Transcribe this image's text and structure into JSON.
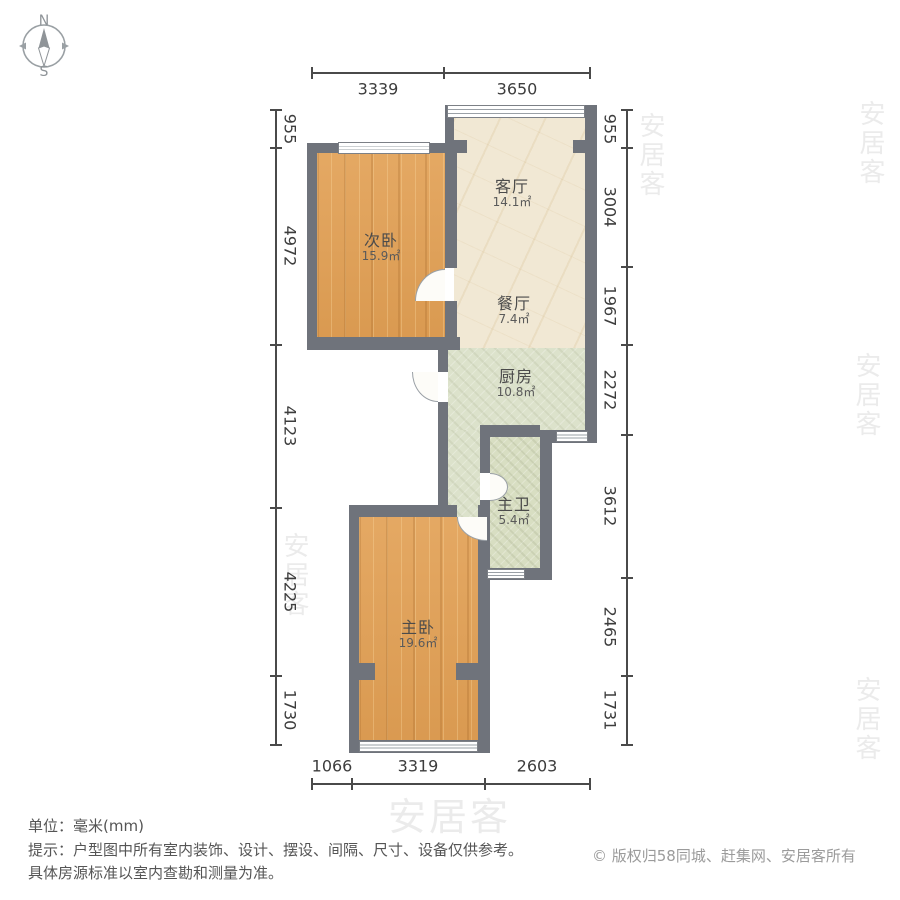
{
  "compass": {
    "north": "N",
    "south": "S"
  },
  "rooms": [
    {
      "key": "secondary_bedroom",
      "name": "次卧",
      "area": "15.9㎡"
    },
    {
      "key": "living_room",
      "name": "客厅",
      "area": "14.1㎡"
    },
    {
      "key": "dining_room",
      "name": "餐厅",
      "area": "7.4㎡"
    },
    {
      "key": "kitchen",
      "name": "厨房",
      "area": "10.8㎡"
    },
    {
      "key": "master_bathroom",
      "name": "主卫",
      "area": "5.4㎡"
    },
    {
      "key": "master_bedroom",
      "name": "主卧",
      "area": "19.6㎡"
    }
  ],
  "dimensions": {
    "top": [
      "3339",
      "3650"
    ],
    "bottom": [
      "1066",
      "3319",
      "2603"
    ],
    "left": [
      "955",
      "4972",
      "4123",
      "4225",
      "1730"
    ],
    "right": [
      "955",
      "3004",
      "1967",
      "2272",
      "3612",
      "2465",
      "1731"
    ]
  },
  "footer": {
    "unit_line": "单位：毫米(mm)",
    "tip_line1": "提示：户型图中所有室内装饰、设计、摆设、间隔、尺寸、设备仅供参考。",
    "tip_line2": "具体房源标准以室内查勘和测量为准。",
    "copyright": "© 版权归58同城、赶集网、安居客所有"
  },
  "watermark": {
    "text": "安居客"
  },
  "colors": {
    "wall": "#6f737b",
    "wood_floor": "#e2a156",
    "marble_floor": "#f1e8d4",
    "tile_floor": "#dce2cb",
    "dimension_text": "#3d3d3d"
  }
}
